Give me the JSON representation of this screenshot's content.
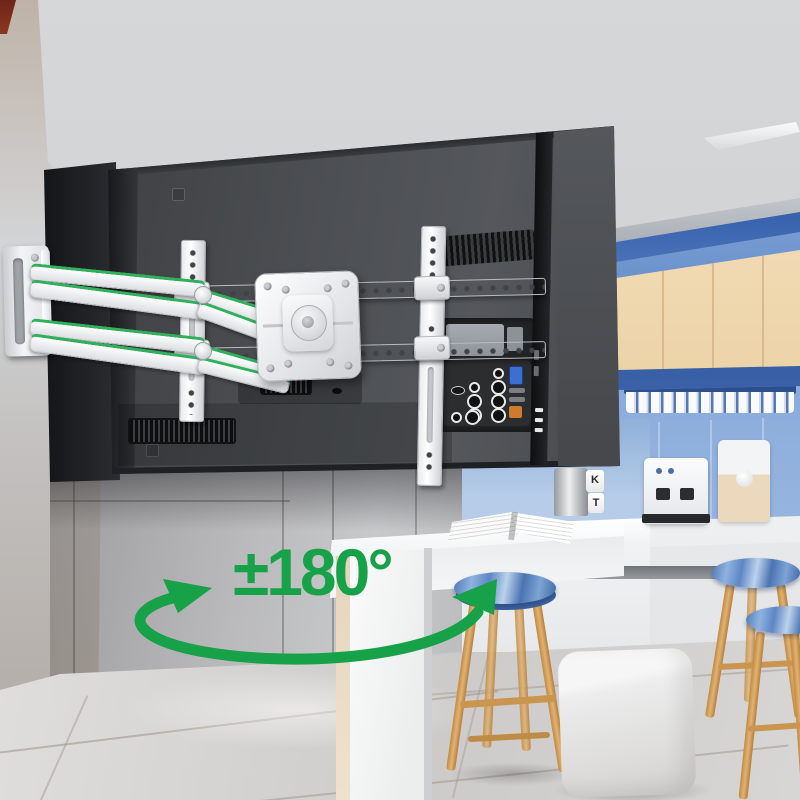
{
  "annotation": {
    "label": "±180°",
    "color": "#17a148",
    "shape": "elliptical-swivel-arc",
    "arrow_direction": "both"
  },
  "scene": {
    "jar_letters": [
      "K",
      "T"
    ],
    "objects": [
      "tv-back-panel",
      "articulating-wall-mount",
      "wood-slat-wall",
      "kitchen-cabinets",
      "bar-counter",
      "bar-stools",
      "cube-ottoman",
      "coffee-machine",
      "mug-row",
      "open-magazine"
    ],
    "palette": {
      "tv_back": "#46484c",
      "mount_white": "#f2f3f5",
      "accent_green": "#17a148",
      "wood_wall": "#dfb684",
      "cabinet_beige": "#efd7af",
      "kitchen_blue": "#5b82c0",
      "counter_white": "#f5f6f7",
      "floor_gray": "#d5d3d1",
      "stool_seat_blue": "#5d87c4",
      "stool_leg_wood": "#d8a55e"
    }
  }
}
